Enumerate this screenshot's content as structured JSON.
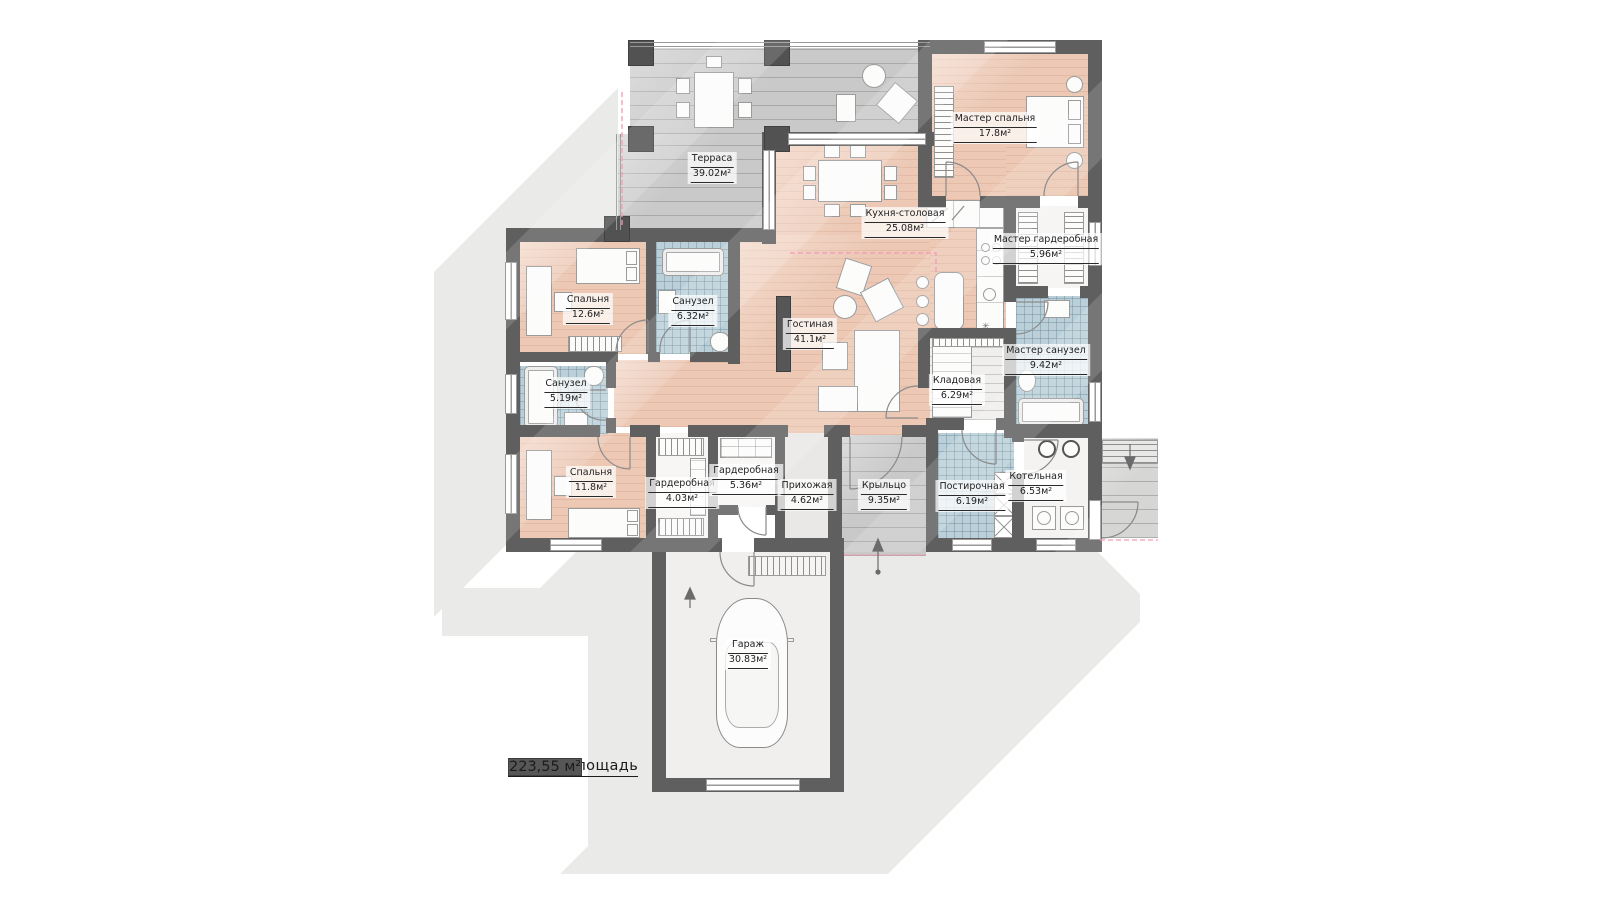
{
  "plan": {
    "type": "floor-plan",
    "language": "ru",
    "total": {
      "label": "Общая площадь",
      "value": "223,55 м²"
    },
    "colors": {
      "wall": "#5f5f5f",
      "floor_living": "#ecc8b5",
      "floor_wet": "#bacfd8",
      "floor_deck": "#c9c9c9",
      "shadow": "#eaeae9",
      "zone_dashed": "#ef9db5"
    },
    "rooms": [
      {
        "name": "Терраса",
        "area": "39.02м²"
      },
      {
        "name": "Мастер спальня",
        "area": "17.8м²"
      },
      {
        "name": "Кухня-столовая",
        "area": "25.08м²"
      },
      {
        "name": "Мастер гардеробная",
        "area": "5.96м²"
      },
      {
        "name": "Мастер санузел",
        "area": "9.42м²"
      },
      {
        "name": "Кладовая",
        "area": "6.29м²"
      },
      {
        "name": "Гостиная",
        "area": "41.1м²"
      },
      {
        "name": "Спальня",
        "area": "12.6м²"
      },
      {
        "name": "Санузел",
        "area": "6.32м²"
      },
      {
        "name": "Санузел",
        "area": "5.19м²"
      },
      {
        "name": "Спальня",
        "area": "11.8м²"
      },
      {
        "name": "Гардеробная",
        "area": "4.03м²"
      },
      {
        "name": "Гардеробная",
        "area": "5.36м²"
      },
      {
        "name": "Прихожая",
        "area": "4.62м²"
      },
      {
        "name": "Крыльцо",
        "area": "9.35м²"
      },
      {
        "name": "Постирочная",
        "area": "6.19м²"
      },
      {
        "name": "Котельная",
        "area": "6.53м²"
      },
      {
        "name": "Гараж",
        "area": "30.83м²"
      }
    ]
  }
}
